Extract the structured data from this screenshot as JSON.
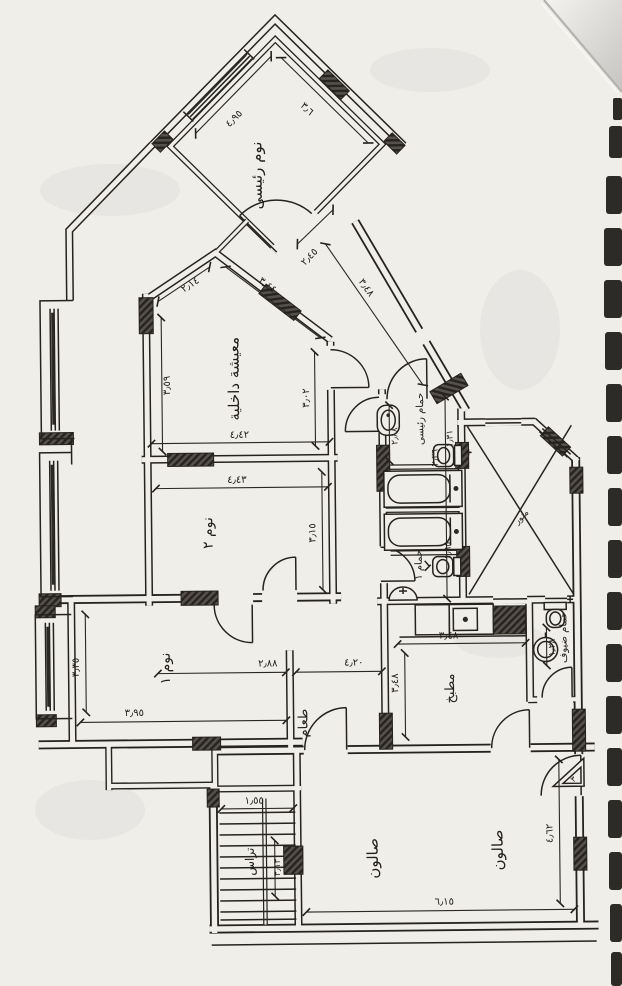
{
  "palette": {
    "paper": "#f0eee9",
    "ink": "#26231e",
    "hatch": "#55514a",
    "film_strip": "#23211d",
    "page_curl": "#c9c7c3"
  },
  "rooms": {
    "master_bedroom": {
      "label": "نوم رئيسى"
    },
    "living": {
      "label": "معيشة داخلية"
    },
    "bedroom2": {
      "label": "نوم ٢"
    },
    "bedroom1": {
      "label": "نوم ١"
    },
    "master_bath": {
      "label": "حمام رئيسى"
    },
    "bath1": {
      "label": "حمام ١"
    },
    "kitchen": {
      "label": "مطبخ"
    },
    "guest_bath": {
      "label": "حمام ضيوف"
    },
    "dining": {
      "label": "طعام"
    },
    "salon_a": {
      "label": "صالون"
    },
    "salon_b": {
      "label": "صالون"
    },
    "terrace": {
      "label": "تراس"
    },
    "light_well": {
      "label": "منور"
    }
  },
  "dims": {
    "master_nw": "٤٫٩٥",
    "master_ne": "٣٫٦",
    "vest_w": "٢٫٤٥",
    "vest_l": "٣٫٤٨",
    "living_nw": "٢٫١٤",
    "living_ne": "٣٫٤٤",
    "living_w": "٣٫٥٩",
    "living_e": "٣٫٠٢",
    "living_s": "٤٫٤٢",
    "bed2_n": "٤٫٤٣",
    "bed2_e": "٣٫١٥",
    "bed1_w": "٣٫٣٥",
    "bed1_s": "٣٫٩٥",
    "hall_a": "٢٫٨٨",
    "hall_b": "٤٫٢٠",
    "mbath_w": "٢٫٨٨",
    "mbath_mid": "٢٫٣٦",
    "mbath_e": "١٫٣١",
    "bath1_e": "١٫٦٥",
    "kitchen_n": "٣٫٤٨",
    "kitchen_w": "٣٫٤٨",
    "guest_bath_w": "١٫٢٨",
    "salon_s": "٦٫١٥",
    "salon_e": "٤٫٦٢",
    "terrace_n": "١٫٥٥",
    "terrace_e": "٣٫١٣",
    "entry_mark": "٣"
  }
}
